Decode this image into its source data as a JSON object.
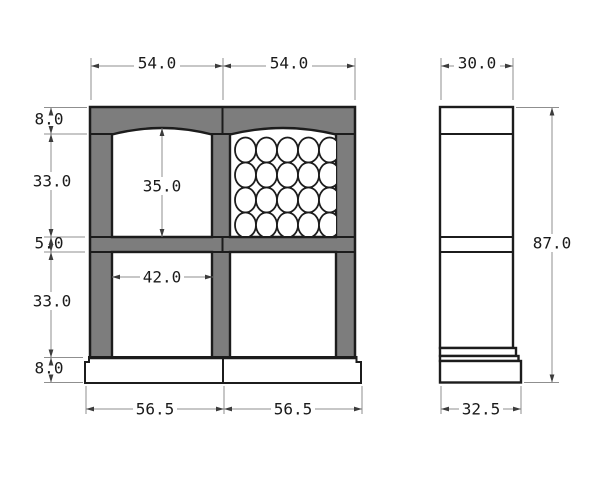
{
  "front_view": {
    "top_dims": [
      "54.0",
      "54.0"
    ],
    "left_dims": [
      "8.0",
      "33.0",
      "5.0",
      "33.0",
      "8.0"
    ],
    "opening_height": "35.0",
    "opening_width": "42.0",
    "bottom_dims": [
      "56.5",
      "56.5"
    ]
  },
  "side_view": {
    "depth_dim": "30.0",
    "height_dim": "87.0",
    "base_depth_dim": "32.5"
  },
  "colors": {
    "frame_fill": "#7d7d7d",
    "outline": "#1c1c1c",
    "dimension_line": "#8f8f8f",
    "arrow": "#3c3c3c",
    "text": "#1a1a1a"
  }
}
